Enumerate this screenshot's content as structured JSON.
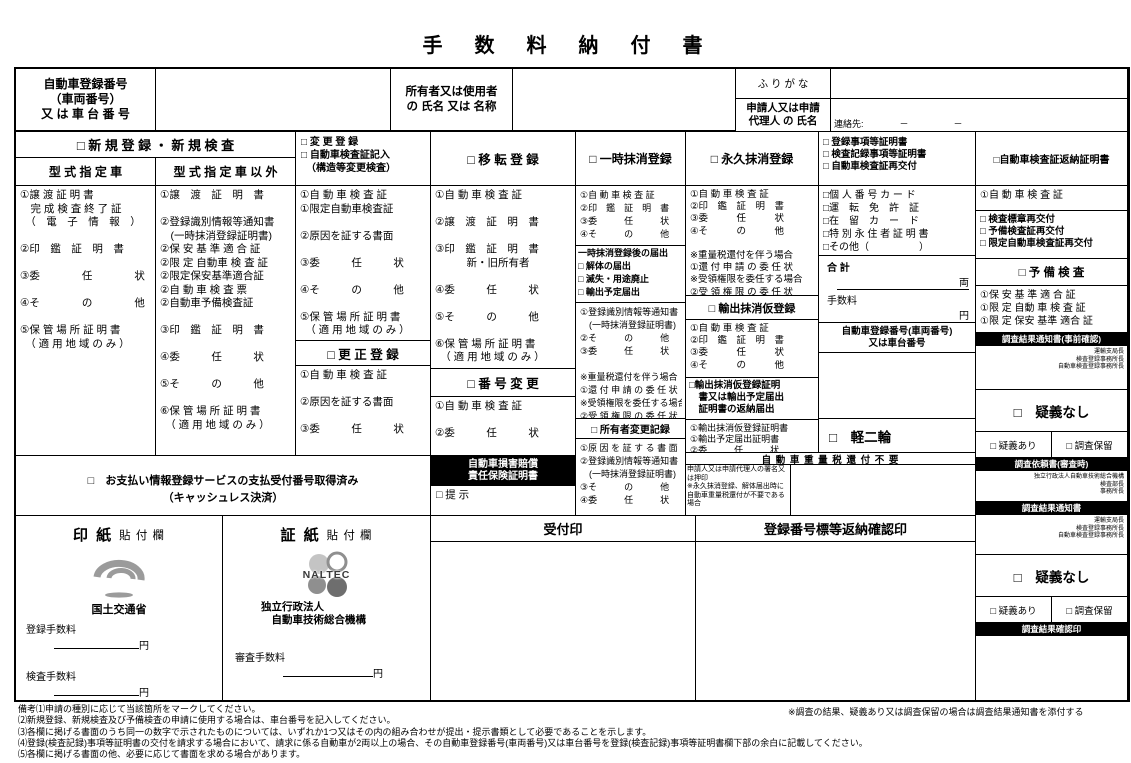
{
  "colors": {
    "ink": "#000000",
    "logo_gray": "#9b9b9b",
    "logo_dark": "#6e6e6e"
  },
  "title": "手　数　料　納　付　書",
  "header": {
    "vehicle_no_label": "自動車登録番号\n（車両番号）\n又 は 車 台 番 号",
    "owner_label": "所有者又は使用者\nの 氏名 又は 名称",
    "furigana_label": "ふ り が な",
    "applicant_label": "申請人又は申請\n代理人 の 氏名",
    "contact_line": "連絡先:　　　　－　　　　　－"
  },
  "new_registration": {
    "title": "□ 新 規 登 録 ・ 新 規 検 査",
    "col1_title": "型 式 指 定 車",
    "col2_title": "型 式 指 定 車 以 外",
    "col1_lines": [
      "①譲 渡 証 明 書",
      "　完 成 検 査 終 了 証",
      "　（　電　子　情　報　）",
      "",
      "②印　鑑　証　明　書",
      "",
      "③委　　　　任　　　　状",
      "",
      "④そ　　　　の　　　　他",
      "",
      "⑤保 管 場 所 証 明 書",
      "　（ 適 用 地 域 の み ）"
    ],
    "col2_lines": [
      "①譲　渡　証　明　書",
      "",
      "②登録識別情報等通知書",
      "　(一時抹消登録証明書)",
      "②保 安 基 準 適 合 証",
      "②限 定 自動車 検 査 証",
      "②限定保安基準適合証",
      "②自 動 車 検 査 票",
      "②自動車予備検査証",
      "",
      "③印　鑑　証　明　書",
      "",
      "④委　　　任　　　状",
      "",
      "⑤そ　　　の　　　他",
      "",
      "⑥保 管 場 所 証 明 書",
      "　（ 適 用 地 域 の み ）"
    ]
  },
  "change_registration": {
    "title_lines": [
      "□ 変 更 登 録",
      "□ 自動車検査証記入",
      "　（構造等変更検査）"
    ],
    "lines": [
      "①自 動 車 検 査 証",
      "①限定自動車検査証",
      "",
      "②原因を証する書面",
      "",
      "③委　　　任　　　状",
      "",
      "④そ　　　の　　　他",
      "",
      "⑤保 管 場 所 証 明 書",
      "　（ 適 用 地 域 の み ）"
    ],
    "correction_title": "□ 更 正 登 録",
    "correction_lines": [
      "①自 動 車 検 査 証",
      "",
      "②原因を証する書面",
      "",
      "③委　　　任　　　状"
    ]
  },
  "transfer_registration": {
    "title": "□ 移 転 登 録",
    "lines": [
      "①自 動 車 検 査 証",
      "",
      "②譲　渡　証　明　書",
      "",
      "③印　鑑　証　明　書",
      "　　　新・旧所有者",
      "",
      "④委　　　任　　　状",
      "",
      "⑤そ　　　の　　　他",
      "",
      "⑥保 管 場 所 証 明 書",
      "　（ 適 用 地 域 の み ）"
    ],
    "number_change_title": "□ 番 号 変 更",
    "number_change_lines": [
      "①自 動 車 検 査 証",
      "",
      "②委　　　任　　　状"
    ],
    "liability_title": "自動車損害賠償\n責任保険証明書",
    "liability_present": "□ 提 示"
  },
  "temporary_deletion": {
    "title": "□ 一時抹消登録",
    "lines1": [
      "①自 動 車 検 査 証",
      "②印　鑑　証　明　書",
      "③委　　　任　　　状",
      "④そ　　　の　　　他"
    ],
    "after_title": "一時抹消登録後の届出",
    "after_checks": [
      "□ 解体の届出",
      "□ 滅失・用途廃止",
      "□ 輸出予定届出"
    ],
    "lines2": [
      "①登録識別情報等通知書",
      "　(一時抹消登録証明書)",
      "②そ　　　の　　　他",
      "③委　　　任　　　状",
      "",
      "※重量税還付を伴う場合",
      "①還 付 申 請 の 委 任 状",
      "※受領権限を委任する場合",
      "②受 領 権 限 の 委 任 状"
    ],
    "owner_change_title": "□ 所有者変更記録",
    "owner_change_lines": [
      "①原 因 を 証 す る 書 面",
      "②登録識別情報等通知書",
      "　(一時抹消登録証明書)",
      "③そ　　　の　　　他",
      "④委　　　任　　　状"
    ]
  },
  "permanent_deletion": {
    "title": "□ 永久抹消登録",
    "lines1": [
      "①自 動 車 検 査 証",
      "②印　鑑　証　明　書",
      "③委　　　任　　　状",
      "④そ　　　の　　　他",
      "",
      "※重量税還付を伴う場合",
      "①還 付 申 請 の 委 任 状",
      "※受領権限を委任する場合",
      "②受 領 権 限 の 委 任 状"
    ],
    "export_title": "□ 輸出抹消仮登録",
    "export_lines": [
      "①自 動 車 検 査 証",
      "②印　鑑　証　明　書",
      "③委　　　任　　　状",
      "④そ　　　の　　　他"
    ],
    "export_return_title_lines": [
      "□輸出抹消仮登録証明",
      "　書又は輸出予定届出",
      "　証明書の返納届出"
    ],
    "export_return_lines": [
      "①輸出抹消仮登録証明書",
      "①輸出予定届出証明書",
      "②委　　　任　　　状"
    ],
    "weight_tax_band": "自 動 車 重 量 税 還 付 不 要",
    "weight_tax_note": "申請人又は申請代理人の署名又は押印\n※永久抹消登録、解体届出時に自動車重量税還付が不要である場合"
  },
  "certificates": {
    "title_lines": [
      "□ 登録事項等証明書",
      "□ 検査記録事項等証明書",
      "□ 自動車検査証再交付"
    ],
    "id_lines": [
      "□個 人 番 号 カ ー ド",
      "□運　転　免　許　証",
      "□在　留　カ　ー　ド",
      "□特 別 永 住 者 証 明 書",
      "□その他（　　　　　）"
    ],
    "total_label": "合 計",
    "total_unit": "両",
    "fee_label": "手数料",
    "fee_unit": "円",
    "vehicle_no_header": "自動車登録番号(車両番号)\n又は車台番号",
    "kei_niirin": "□　軽二輪"
  },
  "return_certificate": {
    "title": "□自動車検査証返納証明書",
    "line": "①自 動 車 検 査 証",
    "reissue_checks": [
      "□ 検査標章再交付",
      "□ 予備検査証再交付",
      "□ 限定自動車検査証再交付"
    ],
    "preliminary_title": "□ 予 備 検 査",
    "preliminary_lines": [
      "①保 安 基 準 適 合 証",
      "①限 定 自動 車 検 査 証",
      "①限 定 保安 基準 適合 証"
    ]
  },
  "investigation": {
    "notice_pre_title": "調査結果通知書(事前確認)",
    "notice_pre_addressees": "運輸支局長\n検査登録事務所長\n自動車検査登録事務所長",
    "no_doubt": "□　疑義なし",
    "doubt": "□ 疑義あり",
    "hold": "□ 調査保留",
    "request_title": "調査依頼書(審査時)",
    "request_addressees": "独立行政法人自動車技術総合機構\n検査部長\n事務所長",
    "notice_title": "調査結果通知書",
    "notice_addressees": "運輸支局長\n検査登録事務所長\n自動車検査登録事務所長",
    "confirm_title": "調査結果確認印"
  },
  "payment": {
    "cashless_line1": "□　お支払い情報登録サービスの支払受付番号取得済み",
    "cashless_line2": "（キャッシュレス決済）",
    "inshi_title_big": "印 紙",
    "inshi_title_small": "貼 付 欄",
    "inshi_org": "国土交通省",
    "inshi_fee1_label": "登録手数料",
    "inshi_fee1_unit": "円",
    "inshi_fee2_label": "検査手数料",
    "inshi_fee2_unit": "円",
    "shoshi_title_big": "証 紙",
    "shoshi_title_small": "貼 付 欄",
    "naltec_logo_text": "NALTEC",
    "shoshi_org": "独立行政法人\n　自動車技術総合機構",
    "shoshi_fee_label": "審査手数料",
    "shoshi_fee_unit": "円",
    "reception_stamp": "受付印",
    "plate_return_stamp": "登録番号標等返納確認印"
  },
  "footer": {
    "notes": [
      "備考⑴申請の種別に応じて当該箇所をマークしてください。",
      "⑵新規登録、新規検査及び予備検査の申請に使用する場合は、車台番号を記入してください。",
      "⑶各欄に掲げる書面のうち同一の数字で示されたものについては、いずれか1つ又はその内の組み合わせが提出・提示書類として必要であることを示します。",
      "⑷登録(検査記録)事項等証明書の交付を請求する場合において、請求に係る自動車が2両以上の場合、その自動車登録番号(車両番号)又は車台番号を登録(検査記録)事項等証明書欄下部の余白に記載してください。",
      "⑸各欄に掲げる書面の他、必要に応じて書面を求める場合があります。"
    ],
    "side_note": "※調査の結果、疑義あり又は調査保留の場合は調査結果通知書を添付する"
  }
}
